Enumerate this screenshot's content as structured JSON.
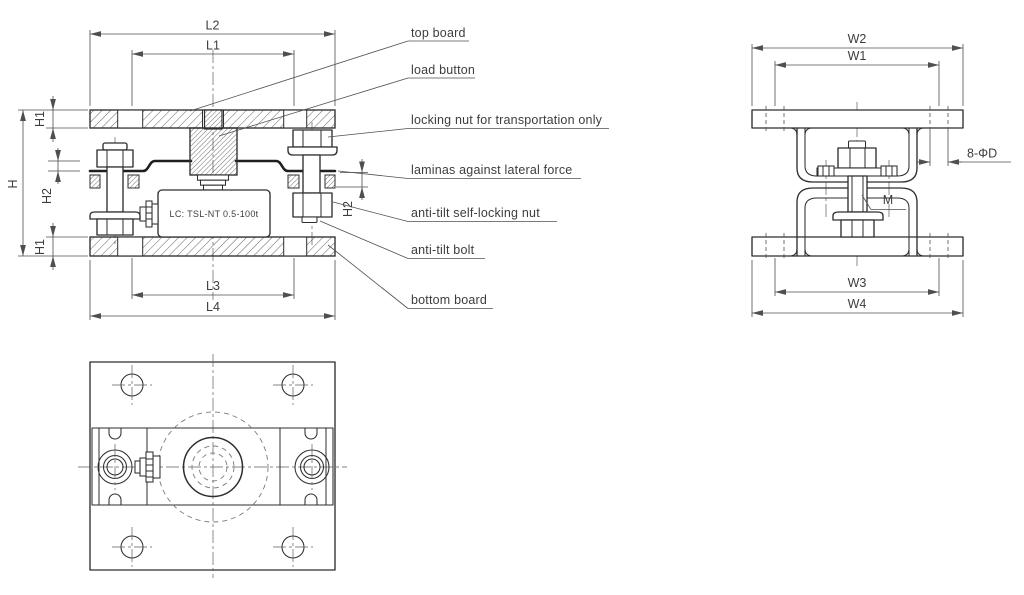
{
  "front_view": {
    "load_cell_label": "LC: TSL-NT 0.5-100t",
    "dims": {
      "L1": "L1",
      "L2": "L2",
      "L3": "L3",
      "L4": "L4",
      "H": "H",
      "H1a": "H1",
      "H1b": "H1",
      "H2a": "H2",
      "H2b": "H2"
    }
  },
  "side_view": {
    "dims": {
      "W1": "W1",
      "W2": "W2",
      "W3": "W3",
      "W4": "W4",
      "holes": "8-ΦD",
      "thread": "M"
    }
  },
  "callouts": {
    "top_board": "top board",
    "load_button": "load button",
    "locking_nut": "locking nut for transportation only",
    "laminas": "laminas against lateral force",
    "anti_tilt_nut": "anti-tilt self-locking nut",
    "anti_tilt_bolt": "anti-tilt bolt",
    "bottom_board": "bottom board"
  },
  "colors": {
    "line": "#2e2e2e",
    "dim": "#4f4f4f",
    "background": "#ffffff"
  }
}
